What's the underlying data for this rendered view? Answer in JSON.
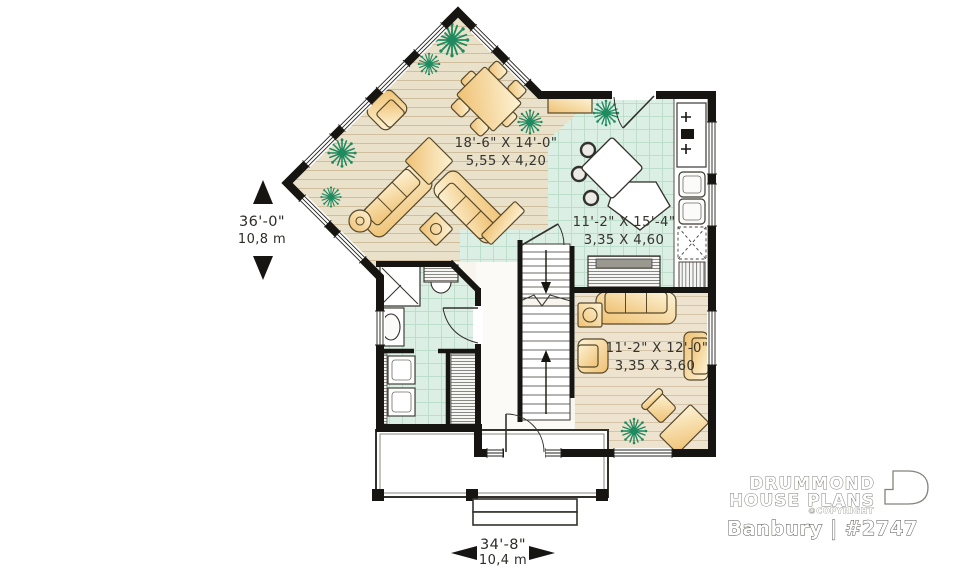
{
  "rooms": {
    "living": {
      "imperial": "18'-6\" X 14'-0\"",
      "metric": "5,55 X 4,20"
    },
    "kitchen": {
      "imperial": "11'-2\" X 15'-4\"",
      "metric": "3,35 X 4,60"
    },
    "family": {
      "imperial": "11'-2\" X 12'-0\"",
      "metric": "3,35 X 3,60"
    }
  },
  "overall_dimensions": {
    "depth": {
      "imperial": "36'-0\"",
      "metric": "10,8 m"
    },
    "width": {
      "imperial": "34'-8\"",
      "metric": "10,4 m"
    }
  },
  "branding": {
    "name_line1": "DRUMMOND",
    "name_line2": "HOUSE PLANS",
    "copyright": "©COPYRIGHT",
    "plan_name": "Banbury | #2747"
  },
  "colors": {
    "wall": "#171511",
    "wood_floor": "#eae1cb",
    "family_floor": "#eee3cf",
    "tile_floor": "#dcefe4",
    "furniture": "#f3cd7e",
    "plant_green": "#1f8a60"
  },
  "icons": {
    "left_dimension_arrows": [
      "arrow-up-icon",
      "arrow-down-icon"
    ],
    "bottom_dimension_arrows": [
      "arrow-left-icon",
      "arrow-right-icon"
    ]
  }
}
